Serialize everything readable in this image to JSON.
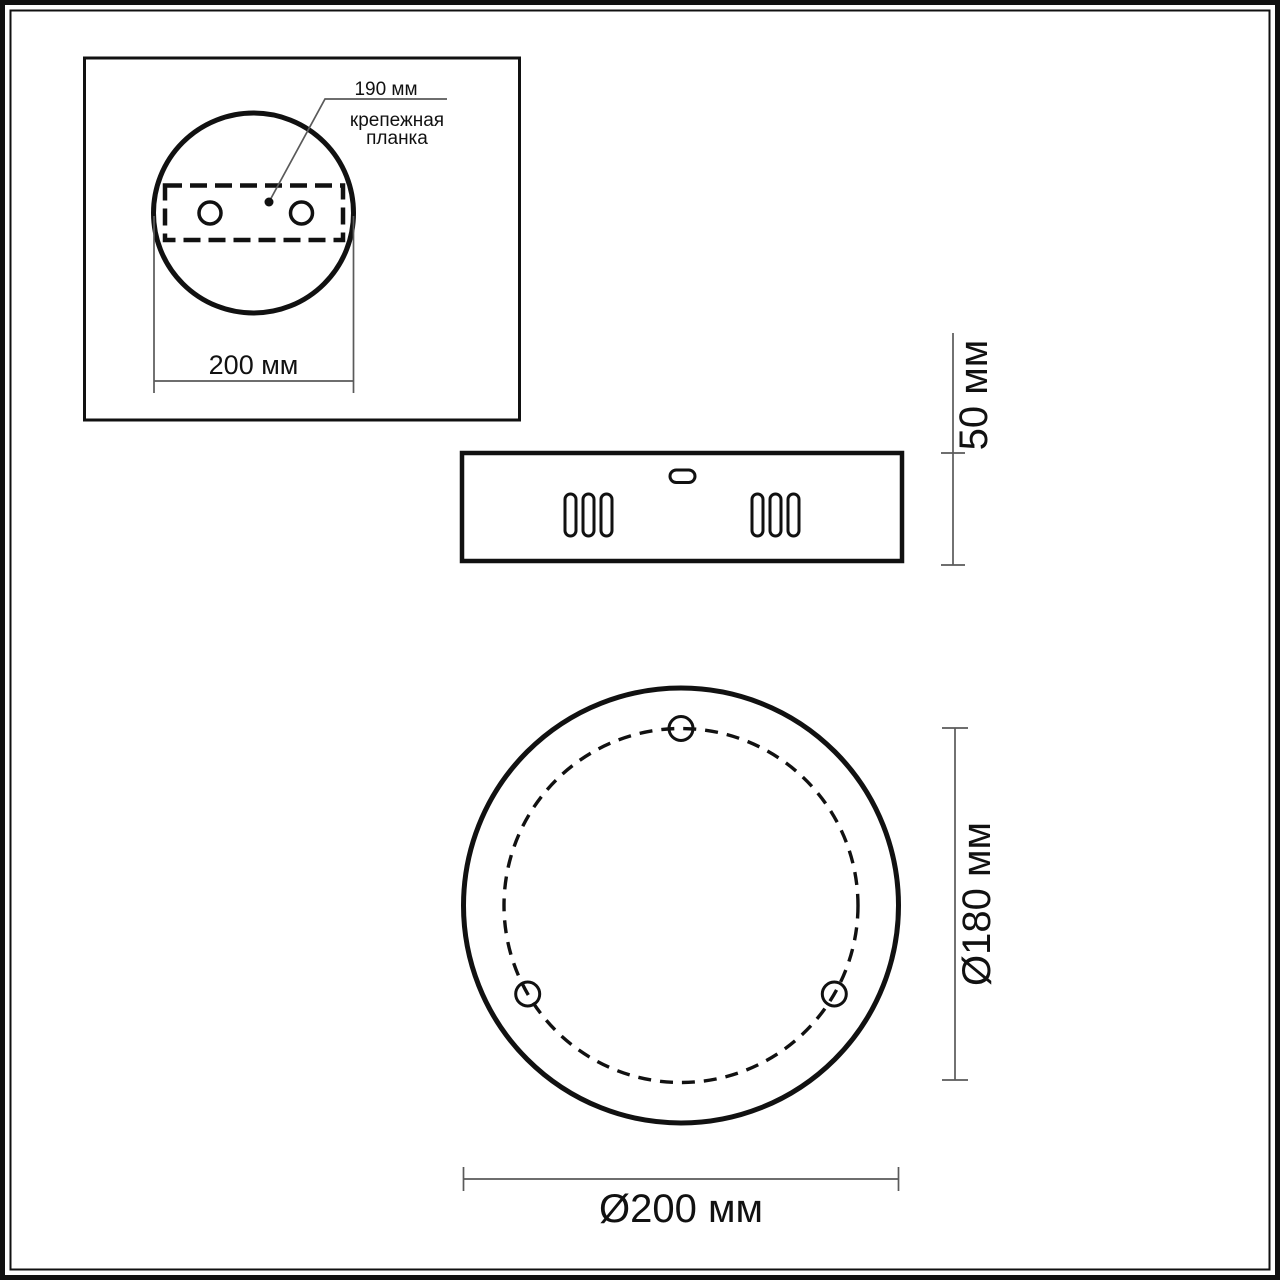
{
  "colors": {
    "ink": "#111111",
    "dim_line": "#5a5a5a",
    "paper": "#ffffff"
  },
  "inset_top_view": {
    "leader_dimension": "190 мм",
    "leader_caption_line1": "крепежная",
    "leader_caption_line2": "планка",
    "width_dimension": "200 мм"
  },
  "side_view": {
    "height_dimension": "50 мм"
  },
  "front_view": {
    "bolt_circle_diameter": "Ø180 мм",
    "outer_diameter": "Ø200 мм"
  }
}
